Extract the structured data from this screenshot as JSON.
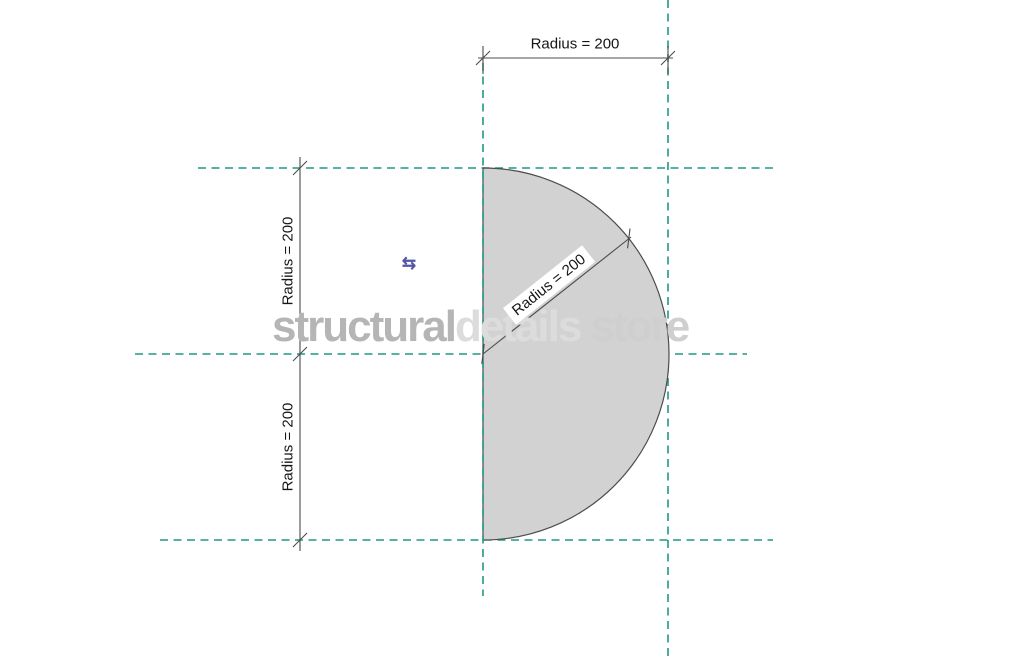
{
  "drawing": {
    "shape": "semicircle-profile",
    "radius_value": 200,
    "dimensions": {
      "top": {
        "label": "Radius = 200"
      },
      "left_upper": {
        "label": "Radius = 200"
      },
      "left_lower": {
        "label": "Radius = 200"
      },
      "diagonal": {
        "label": "Radius = 200"
      }
    },
    "controls": {
      "flip": {
        "glyph": "⇆"
      }
    },
    "watermark": {
      "part1": "structural",
      "part2": "details",
      "part3": " store"
    },
    "colors": {
      "reference_line_teal": "#1e9a82",
      "profile_fill": "#d2d2d2",
      "profile_stroke": "#4c4c4c",
      "dimension_line": "#4c4c4c",
      "dimension_text": "#161616",
      "flip_control_blue": "#5355a5",
      "watermark_dark": "#b5b5b5",
      "watermark_light": "#dcdcdc",
      "watermark_mid": "#cfcfcf",
      "background": "#ffffff"
    }
  }
}
